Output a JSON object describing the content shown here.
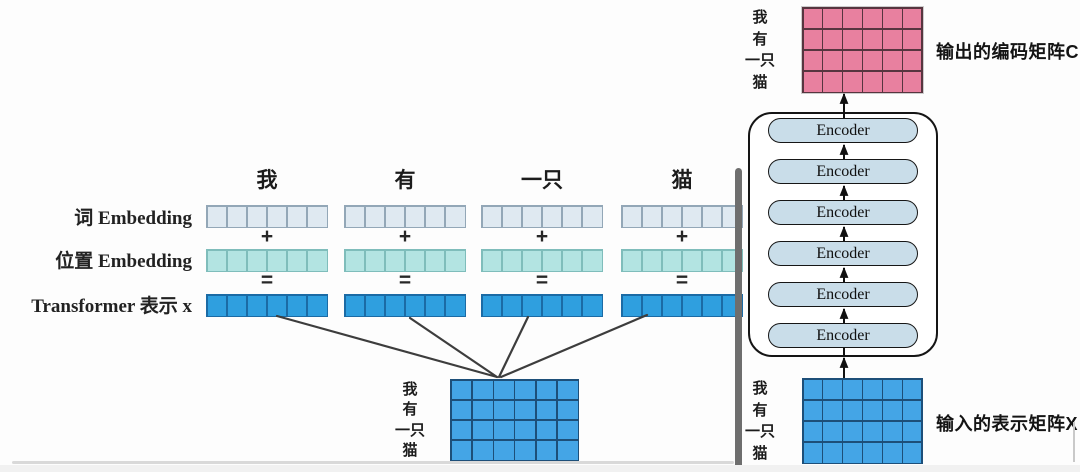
{
  "left_panel": {
    "columns": [
      "我",
      "有",
      "一只",
      "猫"
    ],
    "row_labels": [
      "词  Embedding",
      "位置  Embedding",
      "Transformer 表示  x"
    ],
    "operator_plus": "+",
    "operator_equals": "=",
    "cells_per_strip": 6,
    "matrix_row_labels": [
      "我",
      "有",
      "一只",
      "猫"
    ],
    "matrix": {
      "rows": 4,
      "cols": 6
    }
  },
  "right_panel": {
    "encoder_label": "Encoder",
    "encoder_count": 6,
    "output_matrix_label": "输出的编码矩阵C",
    "input_matrix_label": "输入的表示矩阵X",
    "output_matrix_row_labels": [
      "我",
      "有",
      "一只",
      "猫"
    ],
    "input_matrix_row_labels": [
      "我",
      "有",
      "一只",
      "猫"
    ],
    "output_matrix": {
      "rows": 4,
      "cols": 6
    },
    "input_matrix": {
      "rows": 4,
      "cols": 6
    }
  },
  "colors": {
    "word-fill": "#dfe9f1",
    "word-border": "#93a7b7",
    "pos-fill": "#b3e4e2",
    "pos-border": "#7fbdbb",
    "trans-fill": "#2f9fdf",
    "trans-border": "#1b6ba5",
    "blue-fill": "#44a5e6",
    "blue-line": "#1d4f79",
    "pink-fill": "#e8809f",
    "pink-line": "#57353f",
    "encoder-fill": "#c9dde9",
    "divider": "#6e6e6e"
  }
}
